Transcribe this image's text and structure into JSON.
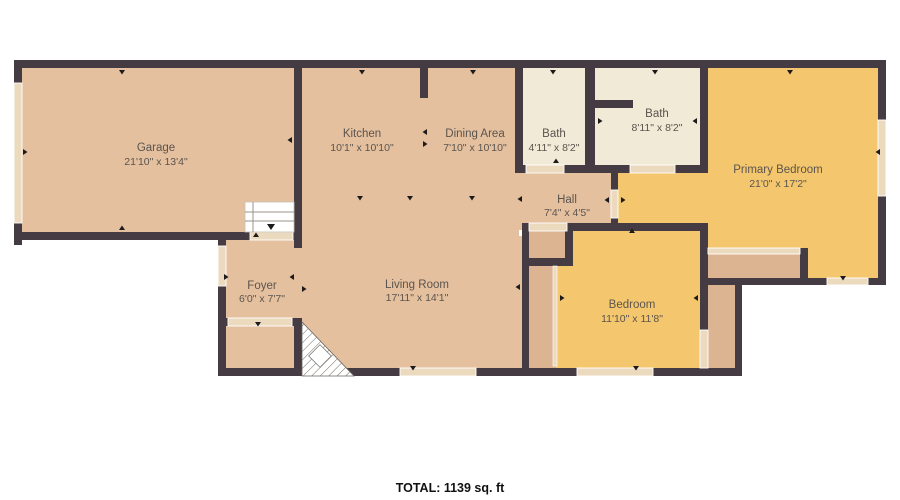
{
  "colors": {
    "wall": "#443c42",
    "floor_tan": "#e4c09f",
    "floor_closet_tan": "#dcb492",
    "floor_cream": "#f1ead7",
    "floor_yellow": "#f4c76e",
    "opening": "#ecdabe",
    "label_text": "#5b544e",
    "total_text": "#111111"
  },
  "rooms": {
    "garage": {
      "name": "Garage",
      "dims": "21'10\" x 13'4\""
    },
    "kitchen": {
      "name": "Kitchen",
      "dims": "10'1\" x 10'10\""
    },
    "dining_area": {
      "name": "Dining Area",
      "dims": "7'10\" x 10'10\""
    },
    "bath": {
      "name": "Bath",
      "dims": "4'11\" x 8'2\""
    },
    "bath2": {
      "name": "Bath",
      "dims": "8'11\" x 8'2\""
    },
    "primary_bedroom": {
      "name": "Primary Bedroom",
      "dims": "21'0\" x 17'2\""
    },
    "hall": {
      "name": "Hall",
      "dims": "7'4\" x 4'5\""
    },
    "foyer": {
      "name": "Foyer",
      "dims": "6'0\" x 7'7\""
    },
    "living_room": {
      "name": "Living Room",
      "dims": "17'11\" x 14'1\""
    },
    "bedroom": {
      "name": "Bedroom",
      "dims": "11'10\" x 11'8\""
    }
  },
  "footer": {
    "total": "TOTAL: 1139 sq. ft"
  }
}
